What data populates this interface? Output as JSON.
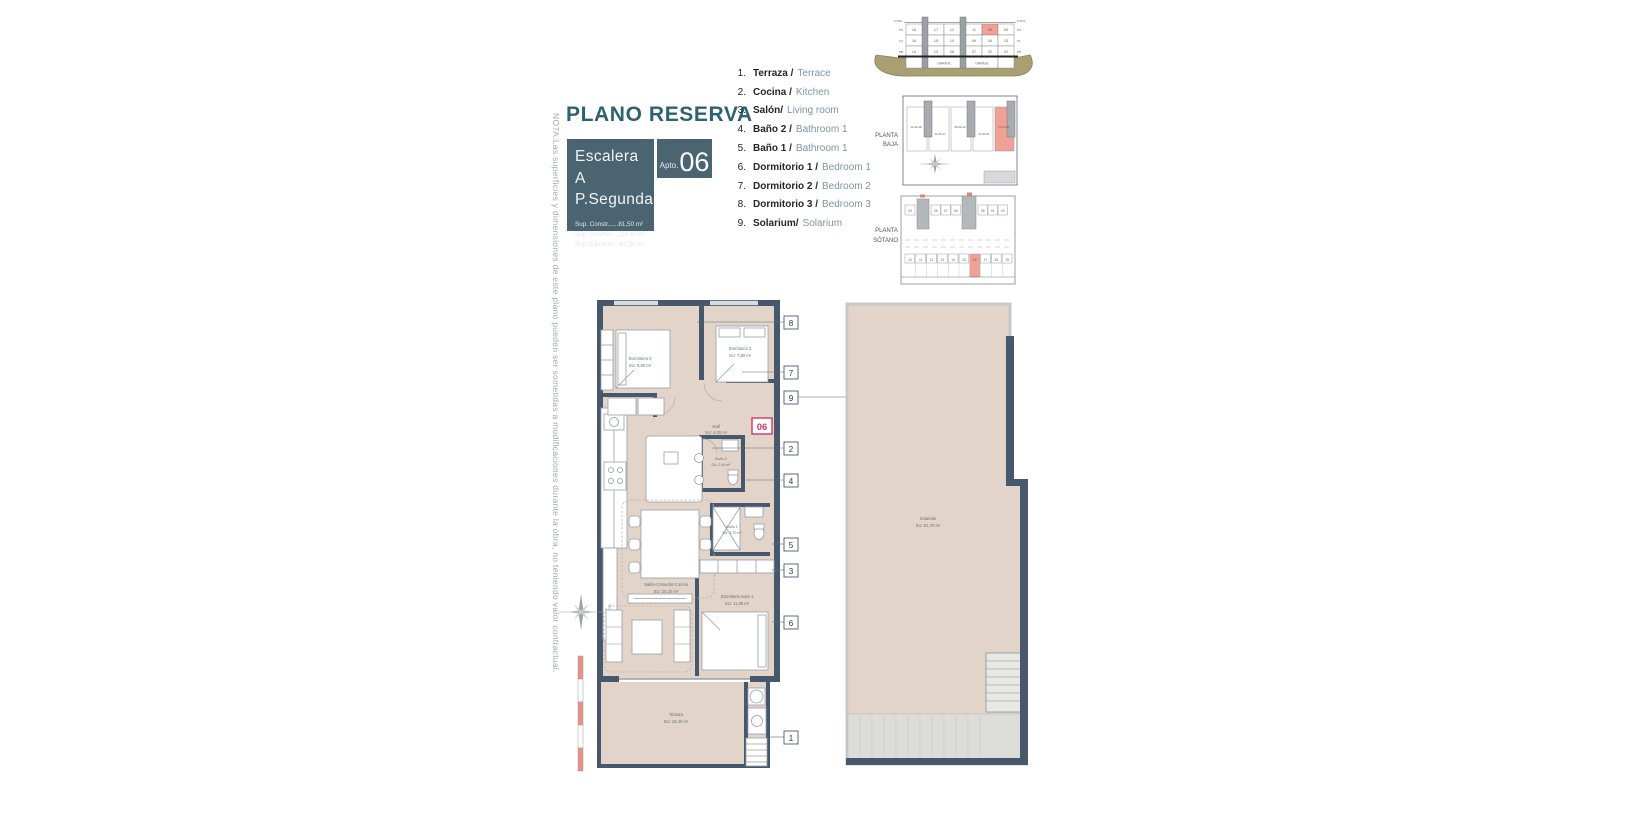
{
  "header": {
    "title": "PLANO RESERVA",
    "escalera_line1": "Escalera A",
    "escalera_line2": "P.Segunda",
    "sup_lines": [
      "Sup. Constr......81,50 m²",
      "Sup.Terrazas.....18,40 m²",
      "Sup.Solarium....82,90 m²"
    ],
    "apto_label": "Apto.",
    "apto_number": "06"
  },
  "note_vertical": "NOTA:Las superficies y dimensiones de este plano pueden ser sometidas a modificaciones durante la obra, no teniendo valor contractual.",
  "legend": {
    "items": [
      {
        "num": "1.",
        "es": "Terraza /",
        "en": "Terrace"
      },
      {
        "num": "2.",
        "es": "Cocina /",
        "en": "Kitchen"
      },
      {
        "num": "3.",
        "es": "Salón/",
        "en": "Living room"
      },
      {
        "num": "4.",
        "es": "Baño 2 /",
        "en": "Bathroom 1"
      },
      {
        "num": "5.",
        "es": "Baño 1 /",
        "en": "Bathroom 1"
      },
      {
        "num": "6.",
        "es": "Dormitorio 1 /",
        "en": "Bedroom 1"
      },
      {
        "num": "7.",
        "es": "Dormitorio 2 /",
        "en": "Bedroom 2"
      },
      {
        "num": "8.",
        "es": "Dormitorio 3 /",
        "en": "Bedroom 3"
      },
      {
        "num": "9.",
        "es": "Solarium/",
        "en": "Solarium"
      }
    ]
  },
  "site": {
    "section": {
      "rows": [
        [
          "18",
          "17",
          "12",
          "11",
          "06",
          "05"
        ],
        [
          "16",
          "15",
          "10",
          "09",
          "04",
          "03"
        ],
        [
          "14",
          "13",
          "08",
          "07",
          "02",
          "01"
        ]
      ],
      "garaje_label": "GARAJE",
      "level_labels": [
        "P.SOL",
        "PS",
        "P1",
        "PB"
      ],
      "highlighted_unit": "06"
    },
    "planta_baja": {
      "label_line1": "PLANTA",
      "label_line2": "BAJA",
      "units": [
        "14-16-18",
        "13-15-17",
        "08-10-12",
        "07-09-11",
        "02-04-06"
      ],
      "highlighted_unit": "02-04-06"
    },
    "planta_sotano": {
      "label_line1": "PLANTA",
      "label_line2": "SÓTANO",
      "top_row": [
        "09",
        "08",
        "07",
        "06",
        "05",
        "04",
        "03"
      ],
      "bottom_row": [
        "10",
        "11",
        "12",
        "13",
        "14",
        "15",
        "16",
        "17",
        "18",
        "19"
      ],
      "highlighted_space": "16"
    }
  },
  "plan": {
    "badge": "06",
    "alacena_label": "ALACENA",
    "callouts": [
      "8",
      "7",
      "9",
      "2",
      "4",
      "5",
      "3",
      "6",
      "1"
    ],
    "rooms": {
      "dorm3": {
        "name": "Dormitorio 3",
        "area": "SU: 9,60 m²"
      },
      "dorm2": {
        "name": "Dormitorio 2",
        "area": "SU: 7,50 m²"
      },
      "hall": {
        "name": "Hall",
        "area": "SU: 4,00 m²"
      },
      "bano2": {
        "name": "Baño 2",
        "area": "SU: 2,40 m²"
      },
      "bano1": {
        "name": "Baño 1",
        "area": "SU: 3,70 m²"
      },
      "salon": {
        "name": "Salón-Comedor-Cocina",
        "area": "SU: 20,20 m²"
      },
      "suite": {
        "name": "Dormitorio suite 1",
        "area": "SU: 11,30 m²"
      },
      "terraza": {
        "name": "Terraza",
        "area": "SU: 18,40 m²"
      },
      "solarium": {
        "name": "Solarium",
        "area": "SU: 81,70 m²"
      }
    }
  },
  "colors": {
    "slate_box": "#4a6472",
    "title_teal": "#2e6273",
    "wall": "#47586c",
    "floor_tan": "#e2d4c8",
    "highlight_red": "#f0a094",
    "badge_magenta": "#cf3566",
    "legend_en_blue": "#7d95a5",
    "note_gray": "#9aabb6",
    "ground_olive": "#a89f72"
  }
}
